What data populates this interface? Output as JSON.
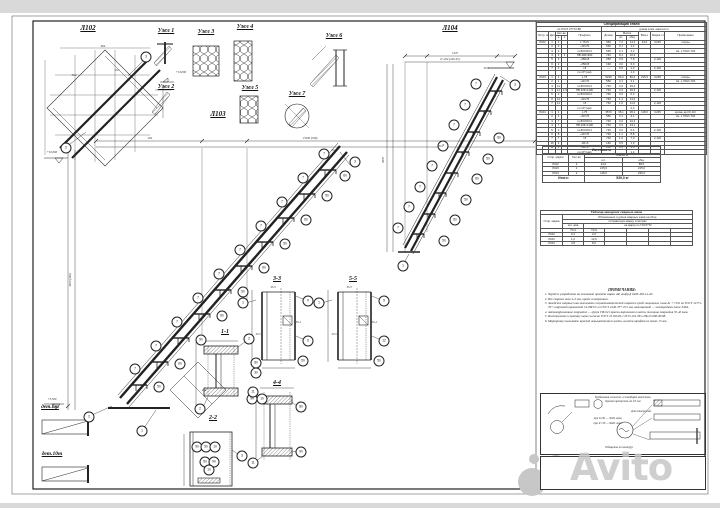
{
  "watermark": {
    "text": "Avito"
  },
  "colors": {
    "line": "#222222",
    "sheet": "#ffffff",
    "background": "#d9d9d9",
    "watermark": "#c7c7c7"
  },
  "labels": {
    "l102": "Л102",
    "l103": "Л103",
    "l104": "Л104",
    "uzel1": "Узел 1",
    "uzel2": "Узел 2",
    "uzel3": "Узел 3",
    "uzel4": "Узел 4",
    "uzel5": "Узел 5",
    "uzel6": "Узел 6",
    "uzel7": "Узел 7",
    "s11": "1-1",
    "s22": "2-2",
    "s33": "3-3",
    "s44": "4-4",
    "s55": "5-5",
    "det6": "дет.6т",
    "det10": "дет.10т"
  },
  "spec_table": {
    "title": "Спецификация стали",
    "sub_left": "по ГОСТ 27772-88",
    "sub_right": "длина в мм, масса в кг",
    "h": {
      "mark": "Отпр. марка",
      "det": "Дет.",
      "qty": "Кол-во",
      "n": "н",
      "z": "з",
      "profile": "Профиль",
      "len": "Длина",
      "mass": "Масса",
      "pc": "шт.",
      "tot": "общ.",
      "all": "Всего",
      "steel": "Марка стали",
      "note": "Примечание"
    },
    "rows": [
      [
        "Л102",
        "1",
        "2",
        "",
        "L 75×5",
        "950",
        "7,2",
        "14,4",
        "44,0",
        "С245",
        "опоры"
      ],
      [
        "",
        "2",
        "2",
        "",
        "–40×70",
        "530",
        "0,7",
        "1,4",
        "",
        "",
        ""
      ],
      [
        "",
        "3",
        "2",
        "",
        "гн.80×60×4",
        "530",
        "2,1",
        "4,2",
        "",
        "",
        "см. х.700/х.704"
      ],
      [
        "",
        "4",
        "2",
        "1",
        "ПВ 406×900",
        "740",
        "8,1",
        "16,2",
        "",
        "",
        ""
      ],
      [
        "",
        "5",
        "2",
        "",
        "–250×8",
        "250",
        "3,9",
        "7,8",
        "",
        "2,120",
        ""
      ],
      [
        "",
        "6",
        "2",
        "",
        "–250×8",
        "190",
        "3,0",
        "6,0",
        "",
        "",
        ""
      ],
      [
        "",
        "7",
        "2",
        "",
        "т.8",
        "—",
        "0,5",
        "1,0",
        "",
        "2,120",
        ""
      ],
      [
        "",
        "",
        "",
        "",
        "по СП (нм)",
        "",
        "",
        "1,4",
        "",
        "",
        ""
      ],
      [
        "Л103",
        "1",
        "1",
        "",
        "L 75",
        "5230",
        "80,2",
        "80,2",
        "215,0",
        "С245",
        "опоры"
      ],
      [
        "",
        "2",
        "1",
        "",
        "–40×70",
        "550",
        "3,1",
        "3,1",
        "",
        "",
        "см. х.700/х.704"
      ],
      [
        "",
        "3",
        "11",
        "",
        "гн.80×60×4",
        "740",
        "3,2",
        "35,2",
        "",
        "",
        ""
      ],
      [
        "",
        "4",
        "11",
        "1,9",
        "ПВ 406×1100",
        "740",
        "3,3",
        "36,3",
        "",
        "2,120",
        ""
      ],
      [
        "",
        "5",
        "2",
        "",
        "гн.80×60×4",
        "740",
        "3,2",
        "6,4",
        "",
        "",
        ""
      ],
      [
        "",
        "6",
        "12",
        "",
        "–40×70",
        "740",
        "1,1",
        "13,2",
        "",
        "",
        ""
      ],
      [
        "",
        "7",
        "11",
        "",
        "т.8",
        "740",
        "1,0",
        "11,0",
        "",
        "2,120",
        ""
      ],
      [
        "",
        "",
        "",
        "",
        "по СП (нм)",
        "",
        "",
        "2,4",
        "",
        "",
        ""
      ],
      [
        "Л104",
        "1",
        "1",
        "",
        "L 75",
        "3570",
        "36,1",
        "36,1",
        "118,0",
        "С245",
        "кроме дет.6т,10т"
      ],
      [
        "",
        "2",
        "1",
        "",
        "–40×70",
        "550",
        "3,1",
        "3,1",
        "",
        "",
        "см. х.700/х.704"
      ],
      [
        "",
        "3",
        "7",
        "",
        "гн.80×60×4",
        "740",
        "3,2",
        "22,4",
        "",
        "",
        ""
      ],
      [
        "",
        "4",
        "7",
        "",
        "ПВ 406×1100",
        "740",
        "3,3",
        "23,1",
        "",
        "",
        ""
      ],
      [
        "",
        "5",
        "2",
        "",
        "гн.80×60×4",
        "740",
        "3,2",
        "6,4",
        "",
        "2,120",
        ""
      ],
      [
        "",
        "6",
        "8",
        "",
        "–40×70",
        "740",
        "1,1",
        "8,8",
        "",
        "",
        ""
      ],
      [
        "",
        "7",
        "7",
        "",
        "т.8",
        "740",
        "1,0",
        "7,0",
        "",
        "2,120",
        ""
      ],
      [
        "",
        "10",
        "2",
        "",
        "–60×6",
        "160",
        "0,5",
        "1,0",
        "",
        "",
        ""
      ],
      [
        "",
        "11",
        "2",
        "",
        "–60×6",
        "160",
        "0,5",
        "1,0",
        "",
        "",
        ""
      ],
      [
        "",
        "",
        "",
        "",
        "по СП (нм)",
        "",
        "",
        "1,4",
        "",
        "",
        ""
      ]
    ]
  },
  "make_table": {
    "title": "Изготовить",
    "h": {
      "mark": "Отпр. марки",
      "qty": "Кол-во",
      "mass": "Масса, кг",
      "pc": "шт.",
      "tot": "общ."
    },
    "rows": [
      [
        "Л102",
        "2",
        "44,0",
        "88,0"
      ],
      [
        "Л103",
        "1",
        "215,0",
        "215,0"
      ],
      [
        "Л104",
        "2",
        "118,0",
        "236,0"
      ]
    ],
    "footer_label": "Итого:",
    "footer_value": "539,0 кг"
  },
  "weld_table": {
    "title": "Таблица заводских сварных швов",
    "sub1": "Обозначения и длина сварных швов на сбор.",
    "sub2": "отправочную марку, в метрах",
    "h": {
      "mark": "Отпр. марка",
      "cat": "кат. шва",
      "per": "на марку по ГОСТ/ТУ",
      "c1": "Т3-4",
      "c2": "Т3-6"
    },
    "rows": [
      [
        "Л102",
        "0,4",
        "2,0"
      ],
      [
        "Л103",
        "1,6",
        "12,0"
      ],
      [
        "Л104",
        "4,8",
        "8,0"
      ]
    ]
  },
  "notes": {
    "title": "ПРИМЕЧАНИЯ:",
    "items": [
      "Чертёж разработан на основании проекта марки АР, шифр Д 0409-456-14-АС.",
      "Все сварные швы 4÷5 мм, кроме оговоренных.",
      "Заводские сварные швы выполнять полуавтоматической сваркой в среде защитных газов Ar + CO2 по ГОСТ 14771-76*, сварочной проволокой Св-08Г2С по ГОСТ 2246-70*, Ø 2 мм, автоматной — электродами типа Э46А.",
      "Антикоррозионное покрытие — грунт ГФ-021 красно-коричневого цвета, толщина покрытия 35-40 мкм.",
      "Изготовление и приёмку швов согласно ГОСТ 23118-99, СП 53-101-98 и ПБ 23-000-90/98.",
      "Маркировку выполнять краской невыцветаемого цвета, высота шрифта не менее 15 мм."
    ]
  },
  "quality_box": {
    "title": "Требования согласно «Стандарт качества»",
    "line1": "Кромки притупить до 0,5 мм",
    "lines": [
      "при δ≤30 — Ф18, зенк.",
      "при δ>30 — Ф28, зенк.",
      "Для отверстий",
      "Обварить по контуру"
    ]
  },
  "callouts": [
    {
      "x": 146,
      "y": 57,
      "t": "3"
    },
    {
      "x": 66,
      "y": 148,
      "t": "2"
    },
    {
      "x": 355,
      "y": 162,
      "t": "3"
    },
    {
      "x": 89,
      "y": 417,
      "t": "2"
    },
    {
      "x": 142,
      "y": 431,
      "t": "1"
    },
    {
      "x": 135,
      "y": 369,
      "t": "7"
    },
    {
      "x": 159,
      "y": 387,
      "t": "5п"
    },
    {
      "x": 156,
      "y": 346,
      "t": "7"
    },
    {
      "x": 180,
      "y": 364,
      "t": "6п"
    },
    {
      "x": 177,
      "y": 322,
      "t": "7"
    },
    {
      "x": 201,
      "y": 340,
      "t": "5п"
    },
    {
      "x": 198,
      "y": 298,
      "t": "7"
    },
    {
      "x": 222,
      "y": 316,
      "t": "6п"
    },
    {
      "x": 219,
      "y": 274,
      "t": "7"
    },
    {
      "x": 243,
      "y": 292,
      "t": "5п"
    },
    {
      "x": 240,
      "y": 250,
      "t": "7"
    },
    {
      "x": 264,
      "y": 268,
      "t": "6п"
    },
    {
      "x": 261,
      "y": 226,
      "t": "7"
    },
    {
      "x": 285,
      "y": 244,
      "t": "5п"
    },
    {
      "x": 282,
      "y": 202,
      "t": "7"
    },
    {
      "x": 306,
      "y": 220,
      "t": "6п"
    },
    {
      "x": 303,
      "y": 178,
      "t": "7"
    },
    {
      "x": 327,
      "y": 196,
      "t": "5п"
    },
    {
      "x": 324,
      "y": 154,
      "t": "7"
    },
    {
      "x": 345,
      "y": 176,
      "t": "6п"
    },
    {
      "x": 398,
      "y": 228,
      "t": "7"
    },
    {
      "x": 444,
      "y": 241,
      "t": "5п"
    },
    {
      "x": 409,
      "y": 207,
      "t": "7"
    },
    {
      "x": 455,
      "y": 220,
      "t": "6п"
    },
    {
      "x": 420,
      "y": 187,
      "t": "7"
    },
    {
      "x": 466,
      "y": 200,
      "t": "5п"
    },
    {
      "x": 432,
      "y": 166,
      "t": "7"
    },
    {
      "x": 477,
      "y": 179,
      "t": "6п"
    },
    {
      "x": 443,
      "y": 146,
      "t": "7"
    },
    {
      "x": 488,
      "y": 159,
      "t": "5п"
    },
    {
      "x": 454,
      "y": 125,
      "t": "7"
    },
    {
      "x": 499,
      "y": 138,
      "t": "6п"
    },
    {
      "x": 465,
      "y": 105,
      "t": "7"
    },
    {
      "x": 476,
      "y": 84,
      "t": "7"
    },
    {
      "x": 515,
      "y": 85,
      "t": "3"
    },
    {
      "x": 403,
      "y": 266,
      "t": "1"
    },
    {
      "x": 249,
      "y": 339,
      "t": "2"
    },
    {
      "x": 256,
      "y": 363,
      "t": "8п"
    },
    {
      "x": 256,
      "y": 373,
      "t": "3п"
    },
    {
      "x": 200,
      "y": 409,
      "t": "2"
    },
    {
      "x": 252,
      "y": 399,
      "t": "9п"
    },
    {
      "x": 262,
      "y": 399,
      "t": "1п"
    },
    {
      "x": 197,
      "y": 447,
      "t": "9п"
    },
    {
      "x": 206,
      "y": 447,
      "t": "5п"
    },
    {
      "x": 215,
      "y": 447,
      "t": "1п"
    },
    {
      "x": 205,
      "y": 462,
      "t": "5п"
    },
    {
      "x": 214,
      "y": 462,
      "t": "9п"
    },
    {
      "x": 209,
      "y": 470,
      "t": "1п"
    },
    {
      "x": 242,
      "y": 456,
      "t": "3"
    },
    {
      "x": 243,
      "y": 303,
      "t": "1"
    },
    {
      "x": 308,
      "y": 301,
      "t": "9"
    },
    {
      "x": 308,
      "y": 341,
      "t": "6"
    },
    {
      "x": 303,
      "y": 361,
      "t": "5п"
    },
    {
      "x": 319,
      "y": 303,
      "t": "1"
    },
    {
      "x": 384,
      "y": 301,
      "t": "9"
    },
    {
      "x": 384,
      "y": 341,
      "t": "12"
    },
    {
      "x": 379,
      "y": 361,
      "t": "5п"
    },
    {
      "x": 253,
      "y": 392,
      "t": "11"
    },
    {
      "x": 253,
      "y": 463,
      "t": "11"
    },
    {
      "x": 301,
      "y": 407,
      "t": "8п"
    },
    {
      "x": 301,
      "y": 452,
      "t": "9п"
    }
  ],
  "annotations": [
    {
      "x": 117,
      "y": 70,
      "t": "Уз.1"
    },
    {
      "x": 74,
      "y": 75,
      "t": "Уз.2"
    },
    {
      "x": 273,
      "y": 287,
      "t": "Уз.3"
    },
    {
      "x": 298,
      "y": 322,
      "t": "Уз.4"
    },
    {
      "x": 258,
      "y": 334,
      "t": "Уз.5"
    },
    {
      "x": 349,
      "y": 287,
      "t": "Уз.3"
    },
    {
      "x": 374,
      "y": 322,
      "t": "Уз.4"
    },
    {
      "x": 334,
      "y": 334,
      "t": "Уз.5"
    },
    {
      "x": 486,
      "y": 68,
      "t": "Уз.6"
    },
    {
      "x": 441,
      "y": 146,
      "t": "Уз.7"
    },
    {
      "x": 334,
      "y": 150,
      "t": "Уз.1"
    },
    {
      "x": 310,
      "y": 138,
      "t": "15290 (346)"
    },
    {
      "x": 150,
      "y": 138,
      "t": "294"
    },
    {
      "x": 70,
      "y": 280,
      "t": "4670 (346)",
      "r": 1
    },
    {
      "x": 455,
      "y": 53,
      "t": "1347"
    },
    {
      "x": 450,
      "y": 59,
      "t": "6×294 (249-45)"
    },
    {
      "x": 383,
      "y": 160,
      "t": "4570",
      "r": 1
    },
    {
      "x": 103,
      "y": 46,
      "t": "664"
    },
    {
      "x": 204,
      "y": 390,
      "t": "294"
    },
    {
      "x": 52,
      "y": 152,
      "t": "+10,000"
    },
    {
      "x": 52,
      "y": 399,
      "t": "+3,300"
    },
    {
      "x": 181,
      "y": 72,
      "t": "+10,000"
    }
  ],
  "drawing": {
    "main_steps": [
      [
        131,
        385
      ],
      [
        152,
        362
      ],
      [
        173,
        338
      ],
      [
        194,
        314
      ],
      [
        215,
        290
      ],
      [
        236,
        266
      ],
      [
        257,
        242
      ],
      [
        278,
        218
      ],
      [
        299,
        194
      ],
      [
        320,
        170
      ]
    ],
    "l104_steps": [
      [
        412,
        234
      ],
      [
        423,
        214
      ],
      [
        434,
        193
      ],
      [
        446,
        173
      ],
      [
        457,
        152
      ],
      [
        468,
        132
      ],
      [
        479,
        111
      ],
      [
        490,
        91
      ]
    ]
  }
}
